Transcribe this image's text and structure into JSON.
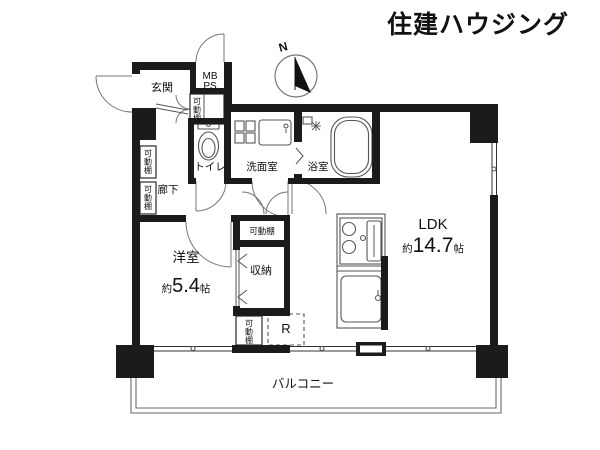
{
  "brand": {
    "logo_text": "住建ハウジング",
    "logo_color": "#bdd0f0"
  },
  "compass": {
    "north_label": "N"
  },
  "rooms": {
    "entrance": {
      "label": "玄関"
    },
    "meter_box": {
      "line1": "MB",
      "line2": "PS"
    },
    "toilet": {
      "label": "トイレ"
    },
    "washroom": {
      "label": "洗面室"
    },
    "bathroom": {
      "label": "浴室"
    },
    "hallway": {
      "label": "廊下"
    },
    "western_room": {
      "label": "洋室",
      "size_prefix": "約",
      "size_value": "5.4",
      "size_unit": "帖"
    },
    "ldk": {
      "label": "LDK",
      "size_prefix": "約",
      "size_value": "14.7",
      "size_unit": "帖"
    },
    "storage": {
      "label": "収納"
    },
    "balcony": {
      "label": "バルコニー"
    },
    "refrigerator": {
      "label": "R"
    },
    "movable_shelf": {
      "label": "可動棚"
    }
  },
  "colors": {
    "wall": "#1b1b1b",
    "text": "#111111"
  }
}
